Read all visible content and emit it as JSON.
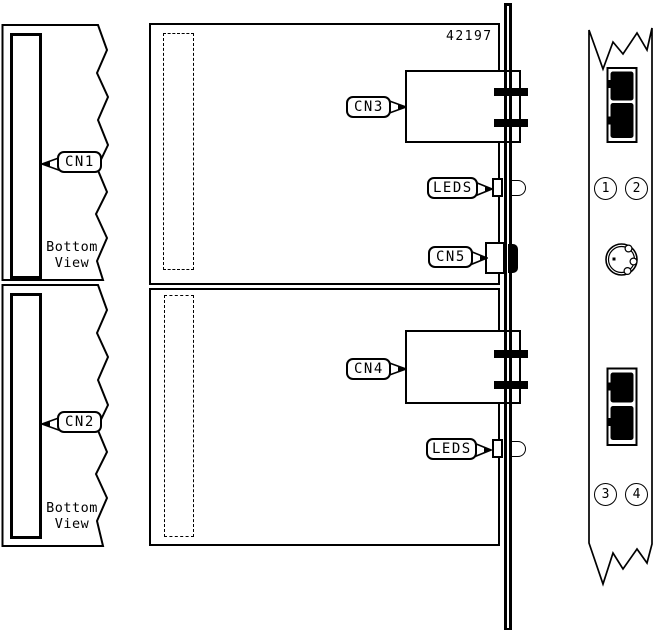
{
  "part_number": "42197",
  "bottom_views": [
    {
      "connector_label": "CN1",
      "caption": [
        "Bottom",
        "View"
      ]
    },
    {
      "connector_label": "CN2",
      "caption": [
        "Bottom",
        "View"
      ]
    }
  ],
  "board_callouts": {
    "cn3": "CN3",
    "leds_top": "LEDS",
    "cn5": "CN5",
    "cn4": "CN4",
    "leds_bottom": "LEDS"
  },
  "front_panel": {
    "ports": [
      "1",
      "2",
      "3",
      "4"
    ]
  },
  "colors": {
    "line": "#000000",
    "background": "#ffffff"
  }
}
